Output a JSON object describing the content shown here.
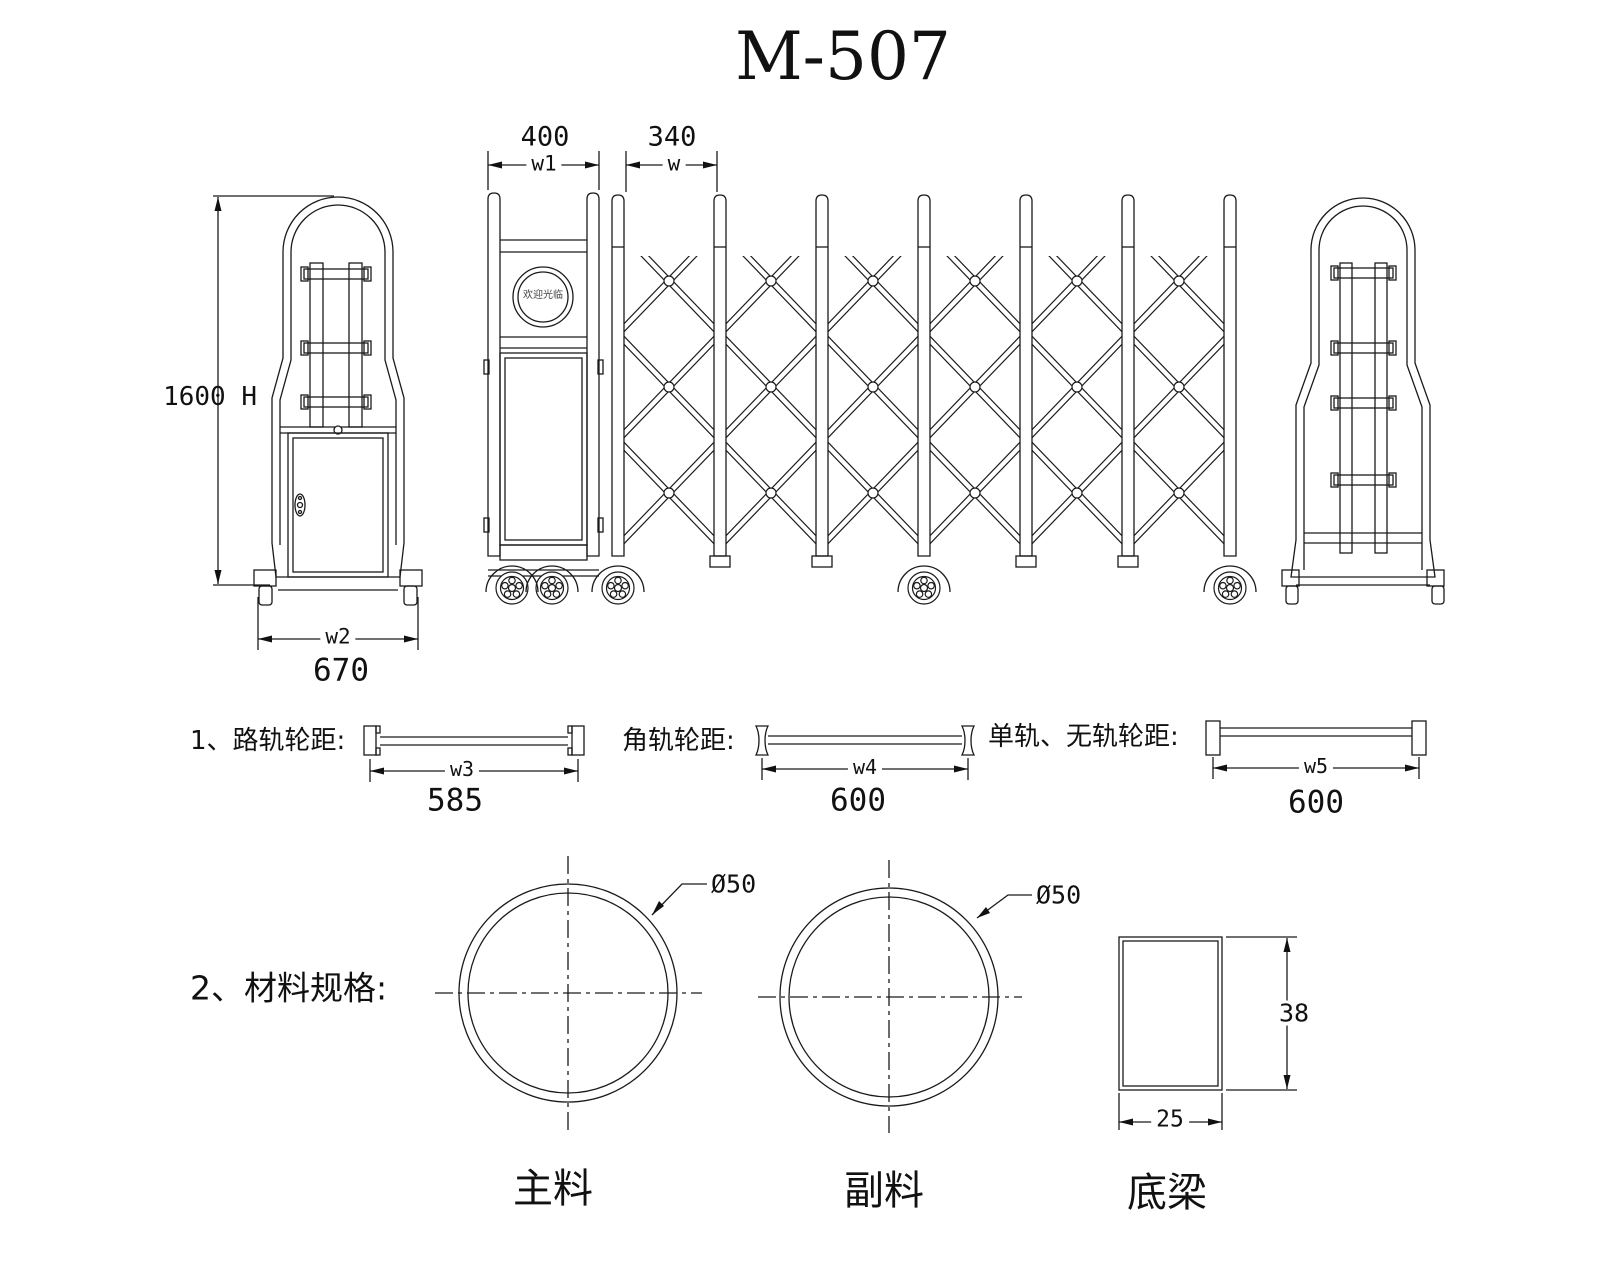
{
  "title": "M-507",
  "elevation": {
    "left_post": {
      "height_dim": "1600 H",
      "width_var": "w2",
      "width_value": "670"
    },
    "main_post": {
      "width_value": "400",
      "width_var": "w1",
      "logo_text": "欢迎光临"
    },
    "gate_unit": {
      "width_value": "340",
      "width_var": "w"
    }
  },
  "wheel_tracks": [
    {
      "label": "1、路轨轮距:",
      "dim_var": "w3",
      "value": "585"
    },
    {
      "label": "角轨轮距:",
      "dim_var": "w4",
      "value": "600"
    },
    {
      "label": "单轨、无轨轮距:",
      "dim_var": "w5",
      "value": "600"
    }
  ],
  "materials": {
    "label": "2、材料规格:",
    "items": [
      {
        "name": "主料",
        "dimension": "Ø50"
      },
      {
        "name": "副料",
        "dimension": "Ø50"
      },
      {
        "name": "底梁",
        "width": "25",
        "height": "38"
      }
    ]
  }
}
